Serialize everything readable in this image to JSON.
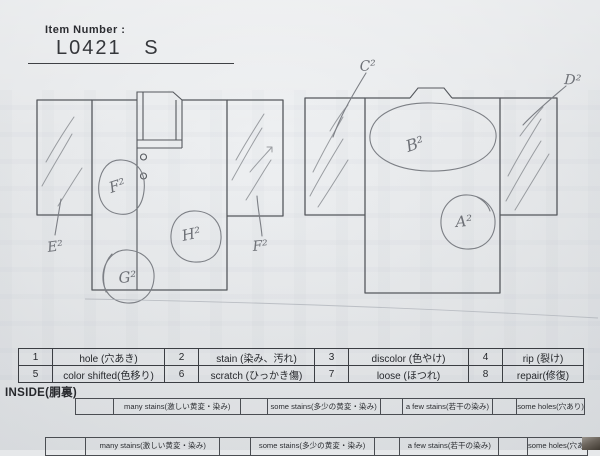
{
  "colors": {
    "paper": "#e6e8ea",
    "print_ink": "#26282c",
    "diagram_line": "#55585d",
    "pencil": "#8b8e93",
    "handwriting": "#6d7076",
    "table_border": "#3b3e43",
    "photo_corner_dark": "#3f3931"
  },
  "header": {
    "item_number_label": "Item Number :",
    "item_number_value": "L0421   S"
  },
  "diagrams": {
    "front": {
      "marks": [
        {
          "id": "F2",
          "label": "F²"
        },
        {
          "id": "H2",
          "label": "H²"
        },
        {
          "id": "G2",
          "label": "G²"
        }
      ],
      "sleeve_labels": [
        {
          "id": "E2",
          "label": "E²"
        },
        {
          "id": "F2",
          "label": "F²"
        }
      ]
    },
    "back": {
      "marks": [
        {
          "id": "B2",
          "label": "B²"
        },
        {
          "id": "A2",
          "label": "A²"
        }
      ],
      "leader_labels": [
        {
          "id": "C2",
          "label": "C²"
        },
        {
          "id": "D2",
          "label": "D²"
        }
      ]
    }
  },
  "defect_table": {
    "rows": [
      [
        {
          "num": "1",
          "label": "hole (穴あき)"
        },
        {
          "num": "2",
          "label": "stain (染み、汚れ)"
        },
        {
          "num": "3",
          "label": "discolor (色やけ)"
        },
        {
          "num": "4",
          "label": "rip (裂け)"
        }
      ],
      [
        {
          "num": "5",
          "label": "color shifted(色移り)"
        },
        {
          "num": "6",
          "label": "scratch (ひっかき傷)"
        },
        {
          "num": "7",
          "label": "loose (ほつれ)"
        },
        {
          "num": "8",
          "label": "repair(修復)"
        }
      ]
    ]
  },
  "inside_section": {
    "title": "INSIDE(胴裏)",
    "options": [
      "many stains(激しい黄変・染み)",
      "some stains(多少の黄変・染み)",
      "a few stains(若干の染み)",
      "some holes(穴あり)"
    ]
  },
  "bottom_partial_row": {
    "options": [
      "many stains(激しい黄変・染み)",
      "some stains(多少の黄変・染み)",
      "a few stains(若干の染み)",
      "some holes(穴あり)"
    ]
  }
}
